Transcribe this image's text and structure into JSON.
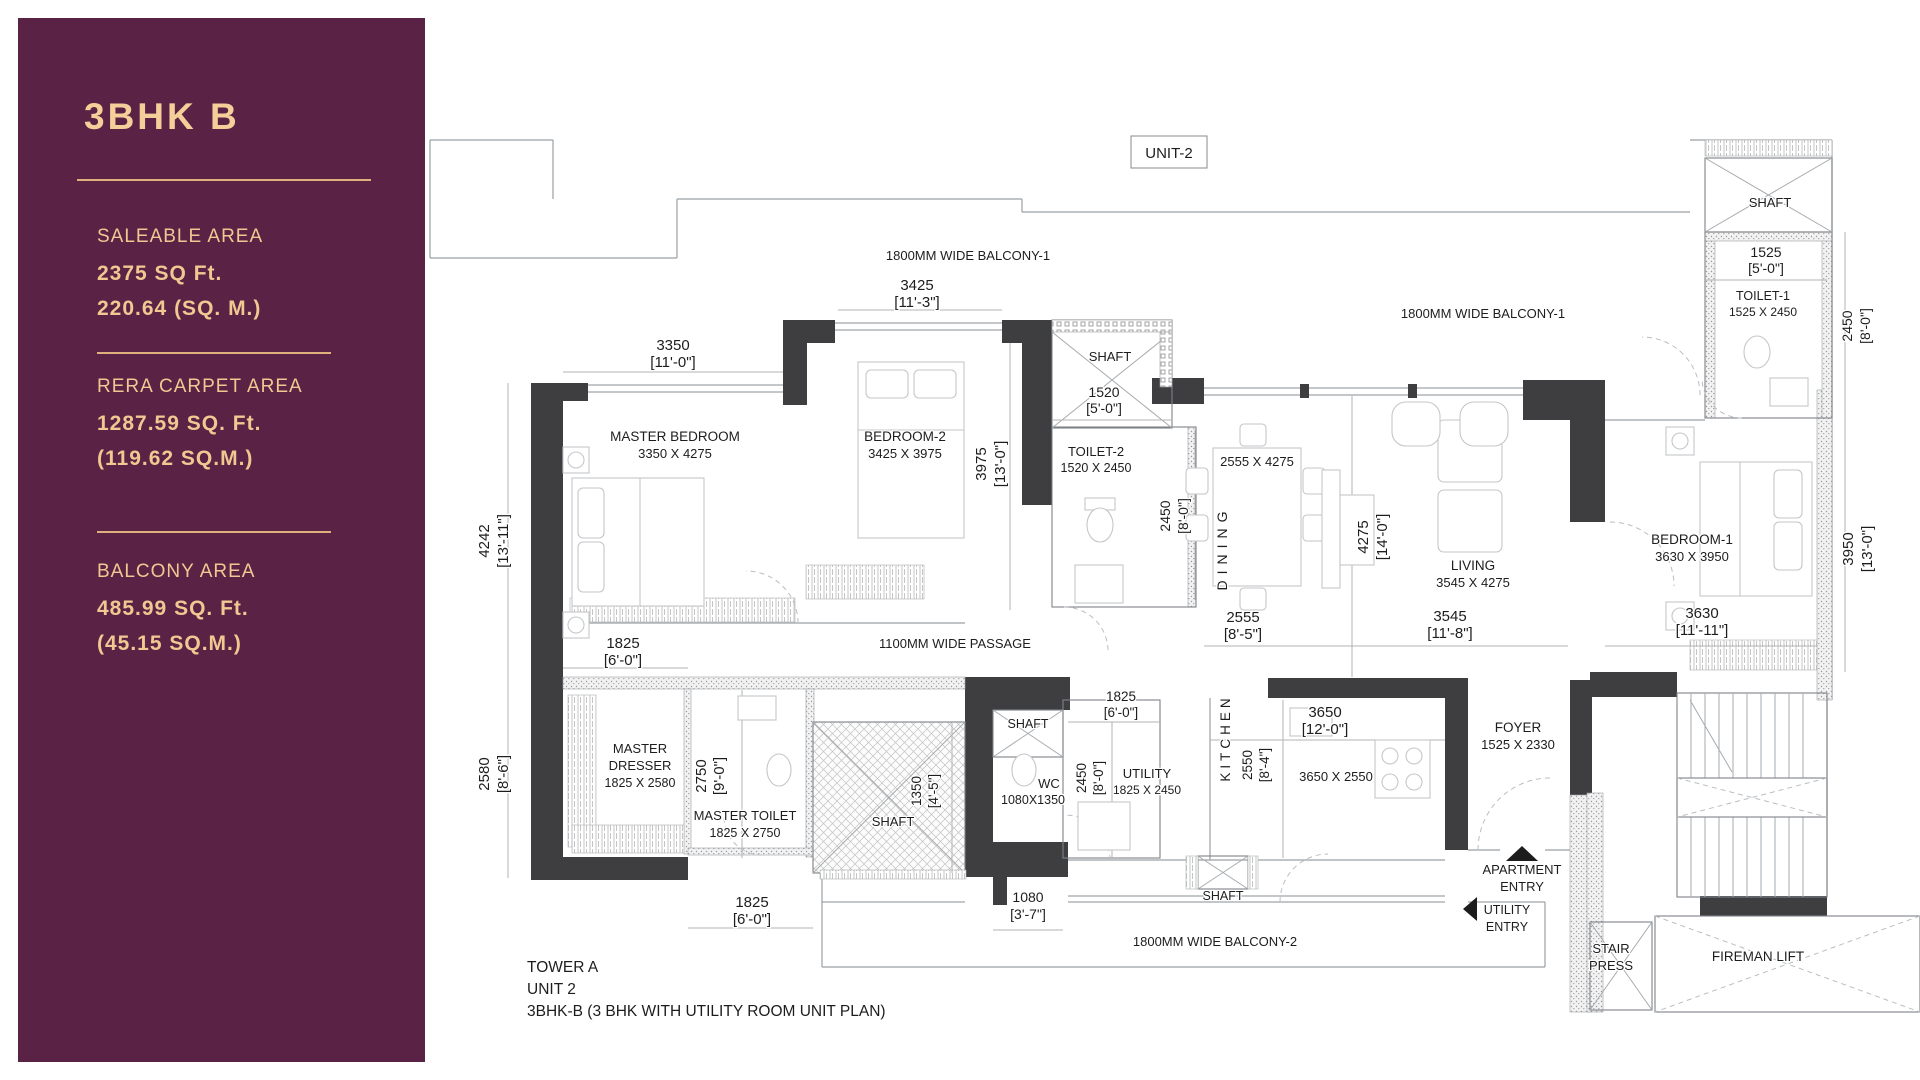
{
  "sidebar": {
    "title": "3BHK B",
    "colors": {
      "background": "#5a2244",
      "accent": "#f0c892",
      "divider": "#e0b07c"
    },
    "sections": [
      {
        "label": "SALEABLE AREA",
        "line1": "2375 SQ Ft.",
        "line2": "220.64 (SQ. M.)"
      },
      {
        "label": "RERA CARPET AREA",
        "line1": "1287.59 SQ. Ft.",
        "line2": "(119.62 SQ.M.)"
      },
      {
        "label": "BALCONY AREA",
        "line1": "485.99 SQ. Ft.",
        "line2": "(45.15 SQ.M.)"
      }
    ]
  },
  "plan": {
    "unit_tag": "UNIT-2",
    "footer_lines": [
      "TOWER A",
      "UNIT 2",
      "3BHK-B (3 BHK WITH UTILITY ROOM UNIT PLAN)"
    ],
    "labels": [
      {
        "n": "unit-tag",
        "t": "UNIT-2",
        "x": 1169,
        "y": 158,
        "s": 15
      },
      {
        "n": "balcony-1-label-left",
        "t": "1800MM WIDE BALCONY-1",
        "x": 968,
        "y": 260,
        "s": 13
      },
      {
        "n": "dim-3425-mm",
        "t": "3425",
        "x": 917,
        "y": 290,
        "s": 15
      },
      {
        "n": "dim-3425-ft",
        "t": "[11'-3\"]",
        "x": 917,
        "y": 307,
        "s": 15
      },
      {
        "n": "dim-3350-mm",
        "t": "3350",
        "x": 673,
        "y": 350,
        "s": 15
      },
      {
        "n": "dim-3350-ft",
        "t": "[11'-0\"]",
        "x": 673,
        "y": 367,
        "s": 15
      },
      {
        "n": "room-master-bedroom",
        "t": "MASTER BEDROOM",
        "x": 675,
        "y": 441,
        "s": 13.5
      },
      {
        "n": "room-master-bedroom-size",
        "t": "3350 X 4275",
        "x": 675,
        "y": 458,
        "s": 13
      },
      {
        "n": "room-bedroom-2",
        "t": "BEDROOM-2",
        "x": 905,
        "y": 441,
        "s": 13.5
      },
      {
        "n": "room-bedroom-2-size",
        "t": "3425 X 3975",
        "x": 905,
        "y": 458,
        "s": 13
      },
      {
        "n": "shaft-top-label",
        "t": "SHAFT",
        "x": 1110,
        "y": 361,
        "s": 13
      },
      {
        "n": "dim-1520-mm",
        "t": "1520",
        "x": 1104,
        "y": 397,
        "s": 14
      },
      {
        "n": "dim-1520-ft",
        "t": "[5'-0\"]",
        "x": 1104,
        "y": 413,
        "s": 14
      },
      {
        "n": "room-toilet-2",
        "t": "TOILET-2",
        "x": 1096,
        "y": 456,
        "s": 13
      },
      {
        "n": "room-toilet-2-size",
        "t": "1520 X 2450",
        "x": 1096,
        "y": 472,
        "s": 12.5
      },
      {
        "n": "dim-2450-toilet2-mm",
        "t": "2450",
        "x": 1170,
        "y": 516,
        "s": 14,
        "r": -90
      },
      {
        "n": "dim-2450-toilet2-ft",
        "t": "[8'-0\"]",
        "x": 1188,
        "y": 516,
        "s": 14,
        "r": -90
      },
      {
        "n": "room-dining-size",
        "t": "2555 X 4275",
        "x": 1257,
        "y": 466,
        "s": 13
      },
      {
        "n": "room-dining",
        "t": "DINING",
        "x": 1227,
        "y": 548,
        "s": 14,
        "r": -90,
        "ls": 6
      },
      {
        "n": "balcony-1-label-right",
        "t": "1800MM WIDE BALCONY-1",
        "x": 1483,
        "y": 318,
        "s": 13
      },
      {
        "n": "room-living",
        "t": "LIVING",
        "x": 1473,
        "y": 570,
        "s": 13.5
      },
      {
        "n": "room-living-size",
        "t": "3545 X 4275",
        "x": 1473,
        "y": 587,
        "s": 13
      },
      {
        "n": "dim-4275-mm",
        "t": "4275",
        "x": 1368,
        "y": 537,
        "s": 15,
        "r": -90
      },
      {
        "n": "dim-4275-ft",
        "t": "[14'-0\"]",
        "x": 1387,
        "y": 537,
        "s": 15,
        "r": -90
      },
      {
        "n": "room-bedroom-1",
        "t": "BEDROOM-1",
        "x": 1692,
        "y": 544,
        "s": 13.5
      },
      {
        "n": "room-bedroom-1-size",
        "t": "3630 X 3950",
        "x": 1692,
        "y": 561,
        "s": 13
      },
      {
        "n": "shaft-topright-label",
        "t": "SHAFT",
        "x": 1770,
        "y": 207,
        "s": 13
      },
      {
        "n": "dim-1525-mm",
        "t": "1525",
        "x": 1766,
        "y": 257,
        "s": 14
      },
      {
        "n": "dim-1525-ft",
        "t": "[5'-0\"]",
        "x": 1766,
        "y": 273,
        "s": 14
      },
      {
        "n": "room-toilet-1",
        "t": "TOILET-1",
        "x": 1763,
        "y": 300,
        "s": 12.5
      },
      {
        "n": "room-toilet-1-size",
        "t": "1525 X 2450",
        "x": 1763,
        "y": 316,
        "s": 12
      },
      {
        "n": "dim-2450-toilet1-mm",
        "t": "2450",
        "x": 1852,
        "y": 326,
        "s": 14,
        "r": -90
      },
      {
        "n": "dim-2450-toilet1-ft",
        "t": "[8'-0\"]",
        "x": 1870,
        "y": 326,
        "s": 14,
        "r": -90
      },
      {
        "n": "dim-4242-mm",
        "t": "4242",
        "x": 489,
        "y": 541,
        "s": 15,
        "r": -90
      },
      {
        "n": "dim-4242-ft",
        "t": "[13'-11\"]",
        "x": 508,
        "y": 541,
        "s": 15,
        "r": -90
      },
      {
        "n": "dim-3975-mm",
        "t": "3975",
        "x": 986,
        "y": 464,
        "s": 15,
        "r": -90
      },
      {
        "n": "dim-3975-ft",
        "t": "[13'-0\"]",
        "x": 1005,
        "y": 464,
        "s": 15,
        "r": -90
      },
      {
        "n": "passage-label",
        "t": "1100MM WIDE PASSAGE",
        "x": 955,
        "y": 648,
        "s": 13
      },
      {
        "n": "dim-2555-mm",
        "t": "2555",
        "x": 1243,
        "y": 622,
        "s": 15
      },
      {
        "n": "dim-2555-ft",
        "t": "[8'-5\"]",
        "x": 1243,
        "y": 639,
        "s": 15
      },
      {
        "n": "dim-3545-mm",
        "t": "3545",
        "x": 1450,
        "y": 621,
        "s": 15
      },
      {
        "n": "dim-3545-ft",
        "t": "[11'-8\"]",
        "x": 1450,
        "y": 638,
        "s": 15
      },
      {
        "n": "dim-3630-mm",
        "t": "3630",
        "x": 1702,
        "y": 618,
        "s": 15
      },
      {
        "n": "dim-3630-ft",
        "t": "[11'-11\"]",
        "x": 1702,
        "y": 635,
        "s": 15
      },
      {
        "n": "dim-3950-mm",
        "t": "3950",
        "x": 1853,
        "y": 549,
        "s": 15,
        "r": -90
      },
      {
        "n": "dim-3950-ft",
        "t": "[13'-0\"]",
        "x": 1872,
        "y": 549,
        "s": 15,
        "r": -90
      },
      {
        "n": "dim-2580-mm",
        "t": "2580",
        "x": 489,
        "y": 774,
        "s": 15,
        "r": -90
      },
      {
        "n": "dim-2580-ft",
        "t": "[8'-6\"]",
        "x": 508,
        "y": 774,
        "s": 15,
        "r": -90
      },
      {
        "n": "dim-1825-dresser-mm",
        "t": "1825",
        "x": 623,
        "y": 648,
        "s": 15
      },
      {
        "n": "dim-1825-dresser-ft",
        "t": "[6'-0\"]",
        "x": 623,
        "y": 665,
        "s": 15
      },
      {
        "n": "room-master-dresser-1",
        "t": "MASTER",
        "x": 640,
        "y": 753,
        "s": 13
      },
      {
        "n": "room-master-dresser-2",
        "t": "DRESSER",
        "x": 640,
        "y": 770,
        "s": 13
      },
      {
        "n": "room-master-dresser-size",
        "t": "1825 X 2580",
        "x": 640,
        "y": 787,
        "s": 12.5
      },
      {
        "n": "dim-2750-mm",
        "t": "2750",
        "x": 706,
        "y": 776,
        "s": 15,
        "r": -90
      },
      {
        "n": "dim-2750-ft",
        "t": "[9'-0\"]",
        "x": 724,
        "y": 776,
        "s": 15,
        "r": -90
      },
      {
        "n": "room-master-toilet",
        "t": "MASTER TOILET",
        "x": 745,
        "y": 820,
        "s": 13
      },
      {
        "n": "room-master-toilet-size",
        "t": "1825 X 2750",
        "x": 745,
        "y": 837,
        "s": 12.5
      },
      {
        "n": "shaft-central-label",
        "t": "SHAFT",
        "x": 893,
        "y": 826,
        "s": 13
      },
      {
        "n": "dim-1350-mm",
        "t": "1350",
        "x": 921,
        "y": 791,
        "s": 13.5,
        "r": -90
      },
      {
        "n": "dim-1350-ft",
        "t": "[4'-5\"]",
        "x": 938,
        "y": 791,
        "s": 13.5,
        "r": -90
      },
      {
        "n": "shaft-wc-label",
        "t": "SHAFT",
        "x": 1028,
        "y": 728,
        "s": 12.5
      },
      {
        "n": "room-wc",
        "t": "WC",
        "x": 1049,
        "y": 788,
        "s": 13
      },
      {
        "n": "room-wc-size",
        "t": "1080X1350",
        "x": 1033,
        "y": 804,
        "s": 12.5
      },
      {
        "n": "dim-2450-utility-mm",
        "t": "2450",
        "x": 1086,
        "y": 778,
        "s": 13.5,
        "r": -90
      },
      {
        "n": "dim-2450-utility-ft",
        "t": "[8'-0\"]",
        "x": 1103,
        "y": 778,
        "s": 13.5,
        "r": -90
      },
      {
        "n": "dim-1825-utility-mm",
        "t": "1825",
        "x": 1121,
        "y": 701,
        "s": 13.5
      },
      {
        "n": "dim-1825-utility-ft",
        "t": "[6'-0\"]",
        "x": 1121,
        "y": 717,
        "s": 13.5
      },
      {
        "n": "room-utility",
        "t": "UTILITY",
        "x": 1147,
        "y": 778,
        "s": 13
      },
      {
        "n": "room-utility-size",
        "t": "1825 X 2450",
        "x": 1147,
        "y": 794,
        "s": 12
      },
      {
        "n": "room-kitchen",
        "t": "KITCHEN",
        "x": 1230,
        "y": 738,
        "s": 13.5,
        "r": -90,
        "ls": 4
      },
      {
        "n": "dim-3650-mm",
        "t": "3650",
        "x": 1325,
        "y": 717,
        "s": 15
      },
      {
        "n": "dim-3650-ft",
        "t": "[12'-0\"]",
        "x": 1325,
        "y": 734,
        "s": 15
      },
      {
        "n": "dim-2550-mm",
        "t": "2550",
        "x": 1252,
        "y": 765,
        "s": 13.5,
        "r": -90
      },
      {
        "n": "dim-2550-ft",
        "t": "[8'-4\"]",
        "x": 1269,
        "y": 765,
        "s": 13.5,
        "r": -90
      },
      {
        "n": "room-kitchen-size",
        "t": "3650 X 2550",
        "x": 1336,
        "y": 781,
        "s": 13
      },
      {
        "n": "room-foyer",
        "t": "FOYER",
        "x": 1518,
        "y": 732,
        "s": 13.5
      },
      {
        "n": "room-foyer-size",
        "t": "1525 X 2330",
        "x": 1518,
        "y": 749,
        "s": 13
      },
      {
        "n": "apartment-entry-1",
        "t": "APARTMENT",
        "x": 1522,
        "y": 874,
        "s": 13
      },
      {
        "n": "apartment-entry-2",
        "t": "ENTRY",
        "x": 1522,
        "y": 891,
        "s": 13
      },
      {
        "n": "utility-entry-1",
        "t": "UTILITY",
        "x": 1507,
        "y": 914,
        "s": 12.5
      },
      {
        "n": "utility-entry-2",
        "t": "ENTRY",
        "x": 1507,
        "y": 931,
        "s": 12.5
      },
      {
        "n": "shaft-kitchen-label",
        "t": "SHAFT",
        "x": 1223,
        "y": 900,
        "s": 12.5
      },
      {
        "n": "balcony-2-label",
        "t": "1800MM WIDE BALCONY-2",
        "x": 1215,
        "y": 946,
        "s": 13
      },
      {
        "n": "dim-1080-mm",
        "t": "1080",
        "x": 1028,
        "y": 902,
        "s": 14
      },
      {
        "n": "dim-1080-ft",
        "t": "[3'-7\"]",
        "x": 1028,
        "y": 919,
        "s": 14
      },
      {
        "n": "dim-1825-mtoilet-mm",
        "t": "1825",
        "x": 752,
        "y": 907,
        "s": 15
      },
      {
        "n": "dim-1825-mtoilet-ft",
        "t": "[6'-0\"]",
        "x": 752,
        "y": 924,
        "s": 15
      },
      {
        "n": "stair-press-1",
        "t": "STAIR",
        "x": 1611,
        "y": 953,
        "s": 13
      },
      {
        "n": "stair-press-2",
        "t": "PRESS",
        "x": 1611,
        "y": 970,
        "s": 13
      },
      {
        "n": "fireman-lift-label",
        "t": "FIREMAN LIFT",
        "x": 1758,
        "y": 961,
        "s": 13.5
      },
      {
        "n": "footer-line-1",
        "t": "TOWER A",
        "x": 527,
        "y": 972,
        "s": 15.5,
        "a": "start"
      },
      {
        "n": "footer-line-2",
        "t": "UNIT 2",
        "x": 527,
        "y": 994,
        "s": 15.5,
        "a": "start"
      },
      {
        "n": "footer-line-3",
        "t": "3BHK-B (3 BHK WITH UTILITY ROOM UNIT PLAN)",
        "x": 527,
        "y": 1016,
        "s": 15.5,
        "a": "start"
      }
    ]
  }
}
